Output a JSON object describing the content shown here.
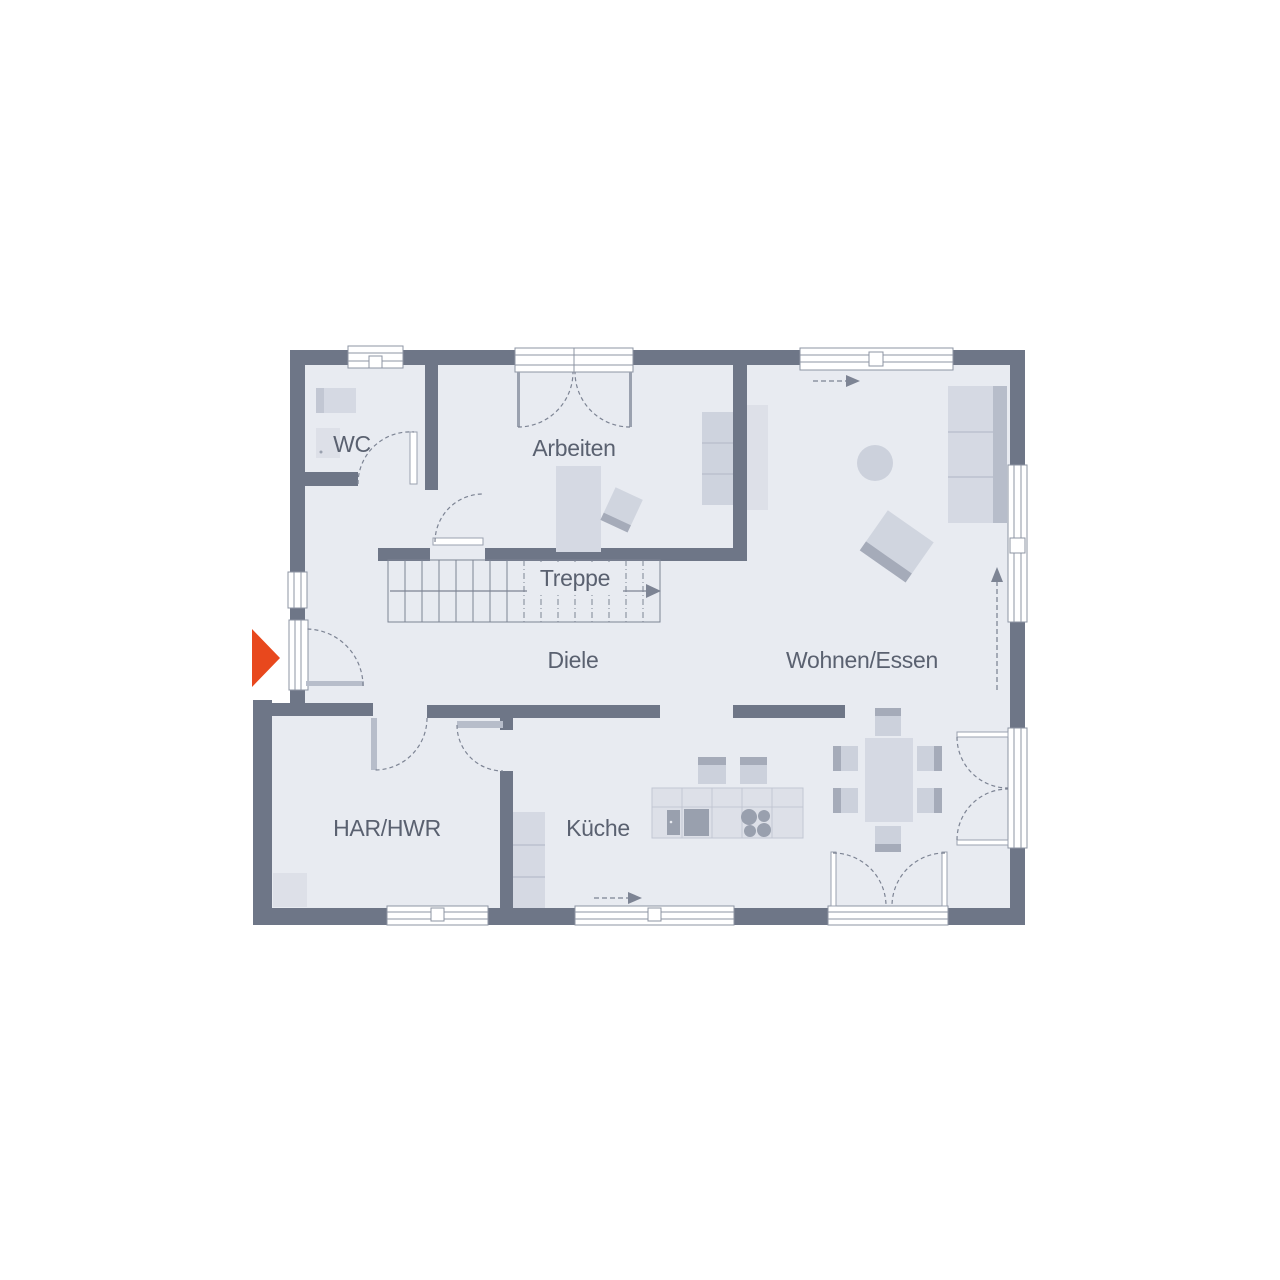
{
  "plan": {
    "type": "residential-floor-plan",
    "rooms": {
      "wc": {
        "label": "WC"
      },
      "arbeiten": {
        "label": "Arbeiten"
      },
      "treppe": {
        "label": "Treppe"
      },
      "diele": {
        "label": "Diele"
      },
      "wohnen_essen": {
        "label": "Wohnen/Essen"
      },
      "har_hwr": {
        "label": "HAR/HWR"
      },
      "kueche": {
        "label": "Küche"
      }
    },
    "markers": {
      "entrance_marker": {
        "icon": "triangle-right-icon",
        "color": "#e8481d"
      },
      "flow_arrows": {
        "icon": "dashed-arrow-icon",
        "count": 3
      },
      "stair_direction": {
        "icon": "arrow-right-icon"
      }
    },
    "colors": {
      "wall": "#6e7687",
      "floor": "#e8ebf1",
      "furniture_light": "#dde0e8",
      "furniture": "#d5d9e3",
      "furniture_dark": "#99a0ae",
      "accent_red": "#e8481d",
      "text": "#5a6170",
      "outline": "#8d94a3"
    }
  }
}
